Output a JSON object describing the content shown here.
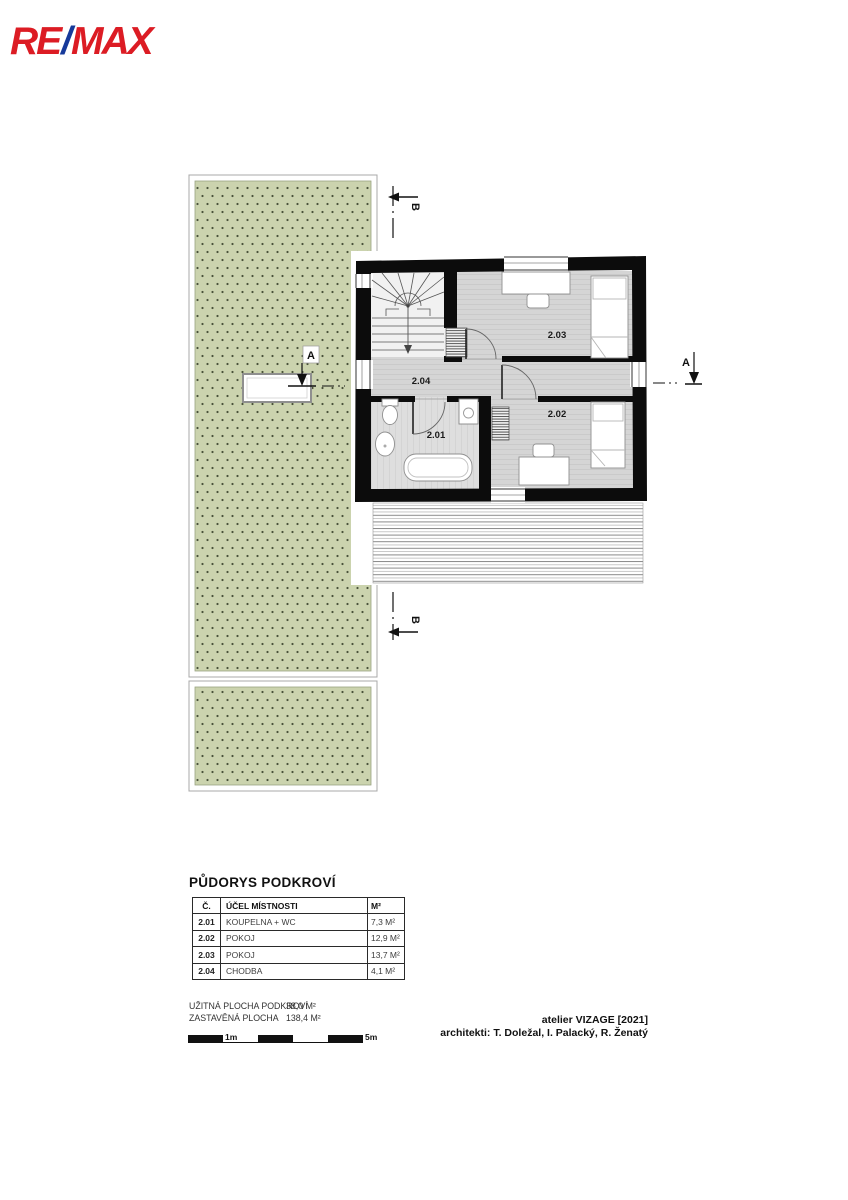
{
  "logo": {
    "re": "RE",
    "slash": "/",
    "max": "MAX"
  },
  "colors": {
    "logo_red": "#dc1c24",
    "logo_blue": "#16399a",
    "garden_green": "#cbd3ae",
    "garden_dot": "#49523a",
    "wall_black": "#0c0c0c",
    "floor_gray": "#d5d5d5"
  },
  "plan": {
    "rooms": [
      {
        "label": "2.01"
      },
      {
        "label": "2.02"
      },
      {
        "label": "2.03"
      },
      {
        "label": "2.04"
      }
    ]
  },
  "markers": {
    "section_a": "A",
    "section_b": "B"
  },
  "legend": {
    "title": "PŮDORYS PODKROVÍ",
    "headers": {
      "num": "Č.",
      "purpose": "ÚČEL MÍSTNOSTI",
      "area": "M²"
    },
    "rows": [
      {
        "num": "2.01",
        "purpose": "KOUPELNA + WC",
        "area": "7,3 M²"
      },
      {
        "num": "2.02",
        "purpose": "POKOJ",
        "area": "12,9 M²"
      },
      {
        "num": "2.03",
        "purpose": "POKOJ",
        "area": "13,7 M²"
      },
      {
        "num": "2.04",
        "purpose": "CHODBA",
        "area": "4,1 M²"
      }
    ]
  },
  "summary": {
    "rows": [
      {
        "label": "UŽITNÁ PLOCHA PODKROVÍ",
        "value": "38,0 M²"
      },
      {
        "label": "ZASTAVĚNÁ PLOCHA",
        "value": "138,4 M²"
      }
    ]
  },
  "scalebar": {
    "label_1m": "1m",
    "label_5m": "5m"
  },
  "credits": {
    "line1": "atelier VIZAGE [2021]",
    "line2": "architekti: T. Doležal, I. Palacký, R. Ženatý"
  }
}
